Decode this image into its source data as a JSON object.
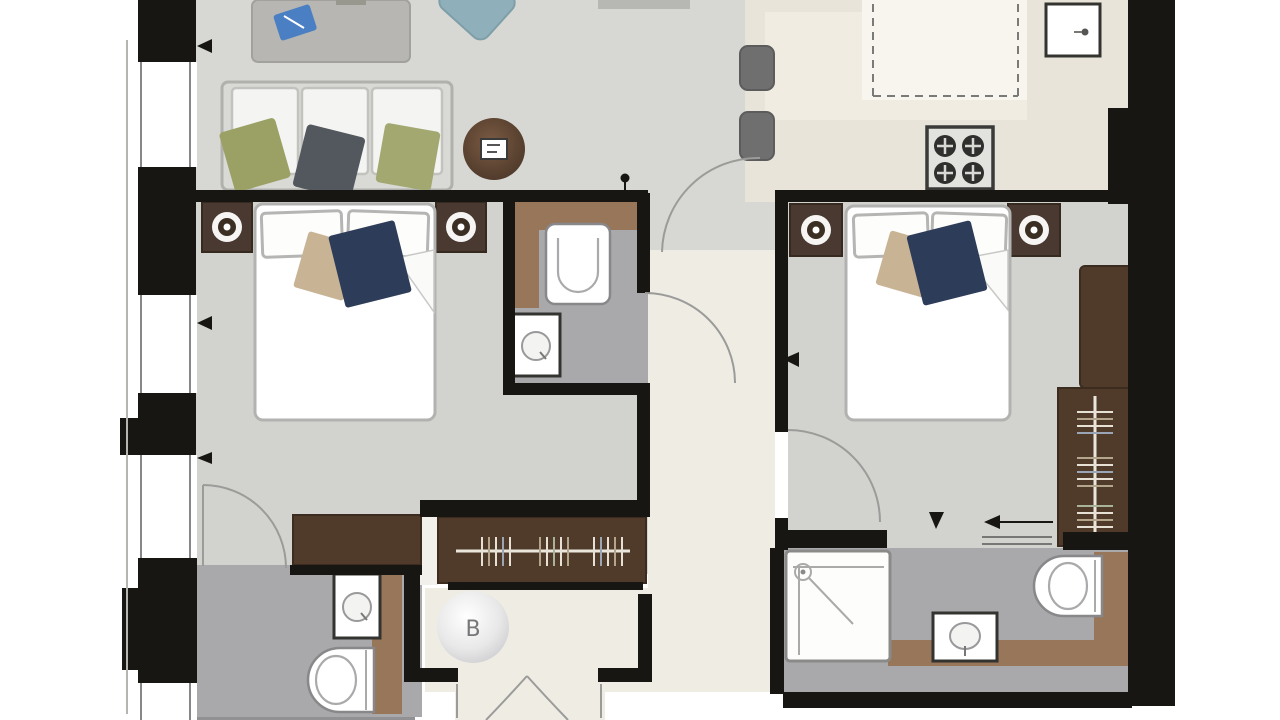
{
  "labels": {
    "hall_marker": "B"
  },
  "colors": {
    "wall": "#171613",
    "floor_living": "#d7d7d4",
    "floor_bedroom": "#d2d2cf",
    "floor_bath": "#a9a9ac",
    "floor_hall": "#efece4",
    "floor_kitchen": "#e9e4d9",
    "kitchen_island": "#f7f5ee",
    "kitchen_counter": "#f1ece1",
    "dark_strip": "#919194",
    "bath_counter_wood": "#97765a",
    "wardrobe_wood": "#503b2b",
    "nightstand_wood": "#4a3930",
    "olive_cushion": "#9ba164",
    "olive_cushion2": "#a2a870",
    "gray_cushion": "#53575e",
    "navy_cushion": "#2d3c58",
    "tan_cushion": "#c8b495",
    "teal_chair": "#8fb0ba",
    "table_gray": "#b7b6b2",
    "blue_item": "#4b7fc3",
    "stool_gray": "#6f6f6f",
    "rail_cream": "#eae6dc",
    "arc_line": "#9b9b99",
    "marker_text": "#77777a"
  }
}
